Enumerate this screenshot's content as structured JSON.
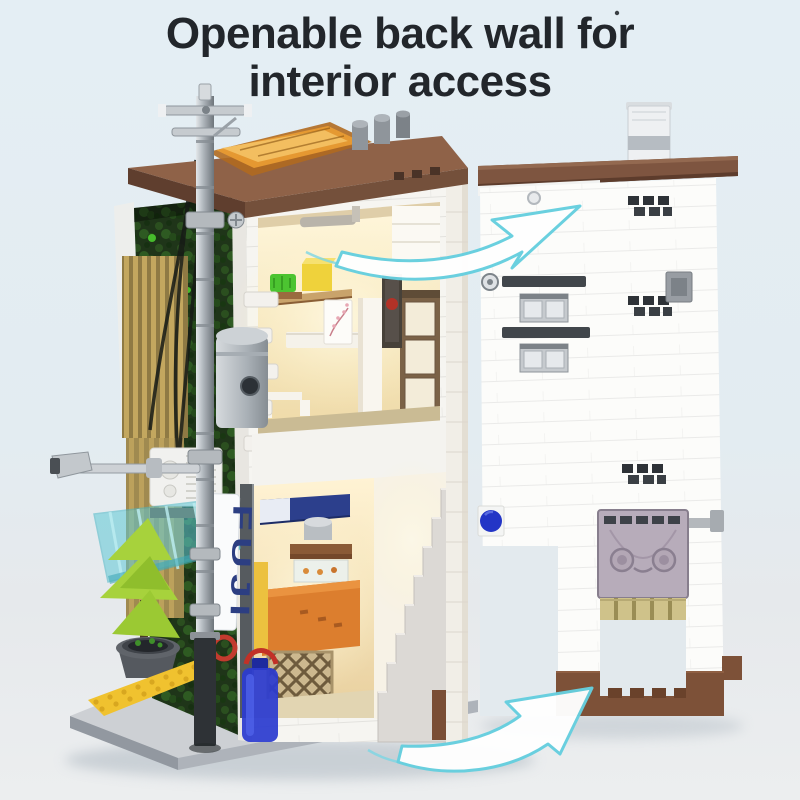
{
  "title": {
    "line1": "Openable back wall for",
    "line2": "interior access"
  },
  "banner": {
    "text": "FUJI"
  },
  "colors": {
    "background_top": "#e4eef4",
    "background_bottom": "#eceeef",
    "title_text": "#22262b",
    "arrow_stroke": "#66cfdf",
    "arrow_fill": "#ffffff",
    "roof_brown": "#8f6248",
    "back_wall_trim_brown": "#7e5540",
    "brick_white": "#fcfcfa",
    "awning_teal": "#5fc9d6",
    "skylight_amber": "#e89b33",
    "ivy_dark_green": "#1f3519",
    "tree_lime": "#a7d23c",
    "tactile_paving_yellow": "#f0c22f",
    "water_jug_blue": "#2b3bd0",
    "knob_blue": "#2335c6",
    "banner_text_navy": "#2c3e82",
    "interior_warm_light": "#fff7dc",
    "shutter_lavender": "#b7acba",
    "pole_silver": "#9aa1a7",
    "baseplate_gray": "#cdd0d4"
  }
}
